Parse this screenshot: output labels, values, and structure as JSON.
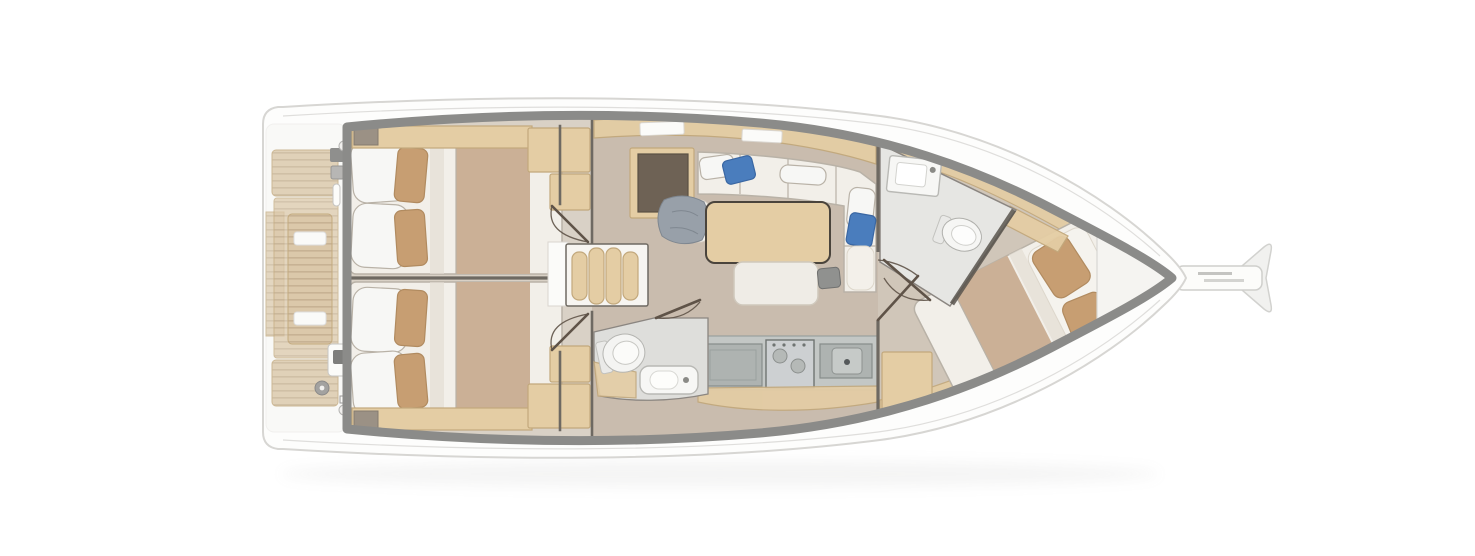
{
  "meta": {
    "title": "Sailing yacht interior layout - overhead floor plan",
    "view": "top-down cutaway",
    "bow_direction": "right"
  },
  "colors": {
    "hull_fill": "#fdfdfc",
    "hull_outline": "#d7d6d3",
    "deck_band": "#8b8b89",
    "interior_base": "#f0ede8",
    "floor_cabin": "#d9d1c6",
    "floor_salon": "#c9bcae",
    "floor_fwd": "#d0c6b9",
    "bow_locker": "#f5f4f1",
    "wood_light": "#e4cda4",
    "wood_trim": "#c2a87c",
    "teak": "#dbc8a9",
    "teak_stripe": "#c7b293",
    "bed_white": "#f2efe9",
    "bed_shadow": "#e2dcd2",
    "blanket_tan": "#cbb096",
    "pillow_tan": "#c79e72",
    "pillow_tan_edge": "#b18b60",
    "pillow_blue": "#4a7dbd",
    "pillow_blue_edge": "#3a67a3",
    "pillow_gray": "#98a0a9",
    "navdesk_brown": "#6e6255",
    "counter_gray": "#c3c7c5",
    "appliance_gray": "#aeb3b1",
    "stainless_steel": "#cdd0d2",
    "fixture_white": "#f7f7f5",
    "fixture_edge": "#b9b9b5",
    "wall_dark": "#6e6962",
    "door_brown": "#5f5348",
    "seam_soft": "#b9b2a7"
  },
  "rooms": [
    {
      "id": "cockpit",
      "label": "cockpit with teak benches and twin helm consoles"
    },
    {
      "id": "aft-cabin-port",
      "label": "aft double cabin (top)"
    },
    {
      "id": "aft-cabin-starboard",
      "label": "aft double cabin (bottom)"
    },
    {
      "id": "companionway",
      "label": "companionway steps"
    },
    {
      "id": "nav-station",
      "label": "chart table with seat"
    },
    {
      "id": "salon",
      "label": "salon with L-sofa, dining table and bench"
    },
    {
      "id": "galley",
      "label": "galley with fridge, stove and sink"
    },
    {
      "id": "aft-head",
      "label": "aft head with toilet and washbasin"
    },
    {
      "id": "forward-head",
      "label": "forward head with toilet and washbasin"
    },
    {
      "id": "forward-cabin",
      "label": "forward double cabin (angled berth)"
    },
    {
      "id": "bow-locker",
      "label": "anchor locker"
    },
    {
      "id": "bowsprit",
      "label": "bowsprit with anchor roller"
    }
  ]
}
